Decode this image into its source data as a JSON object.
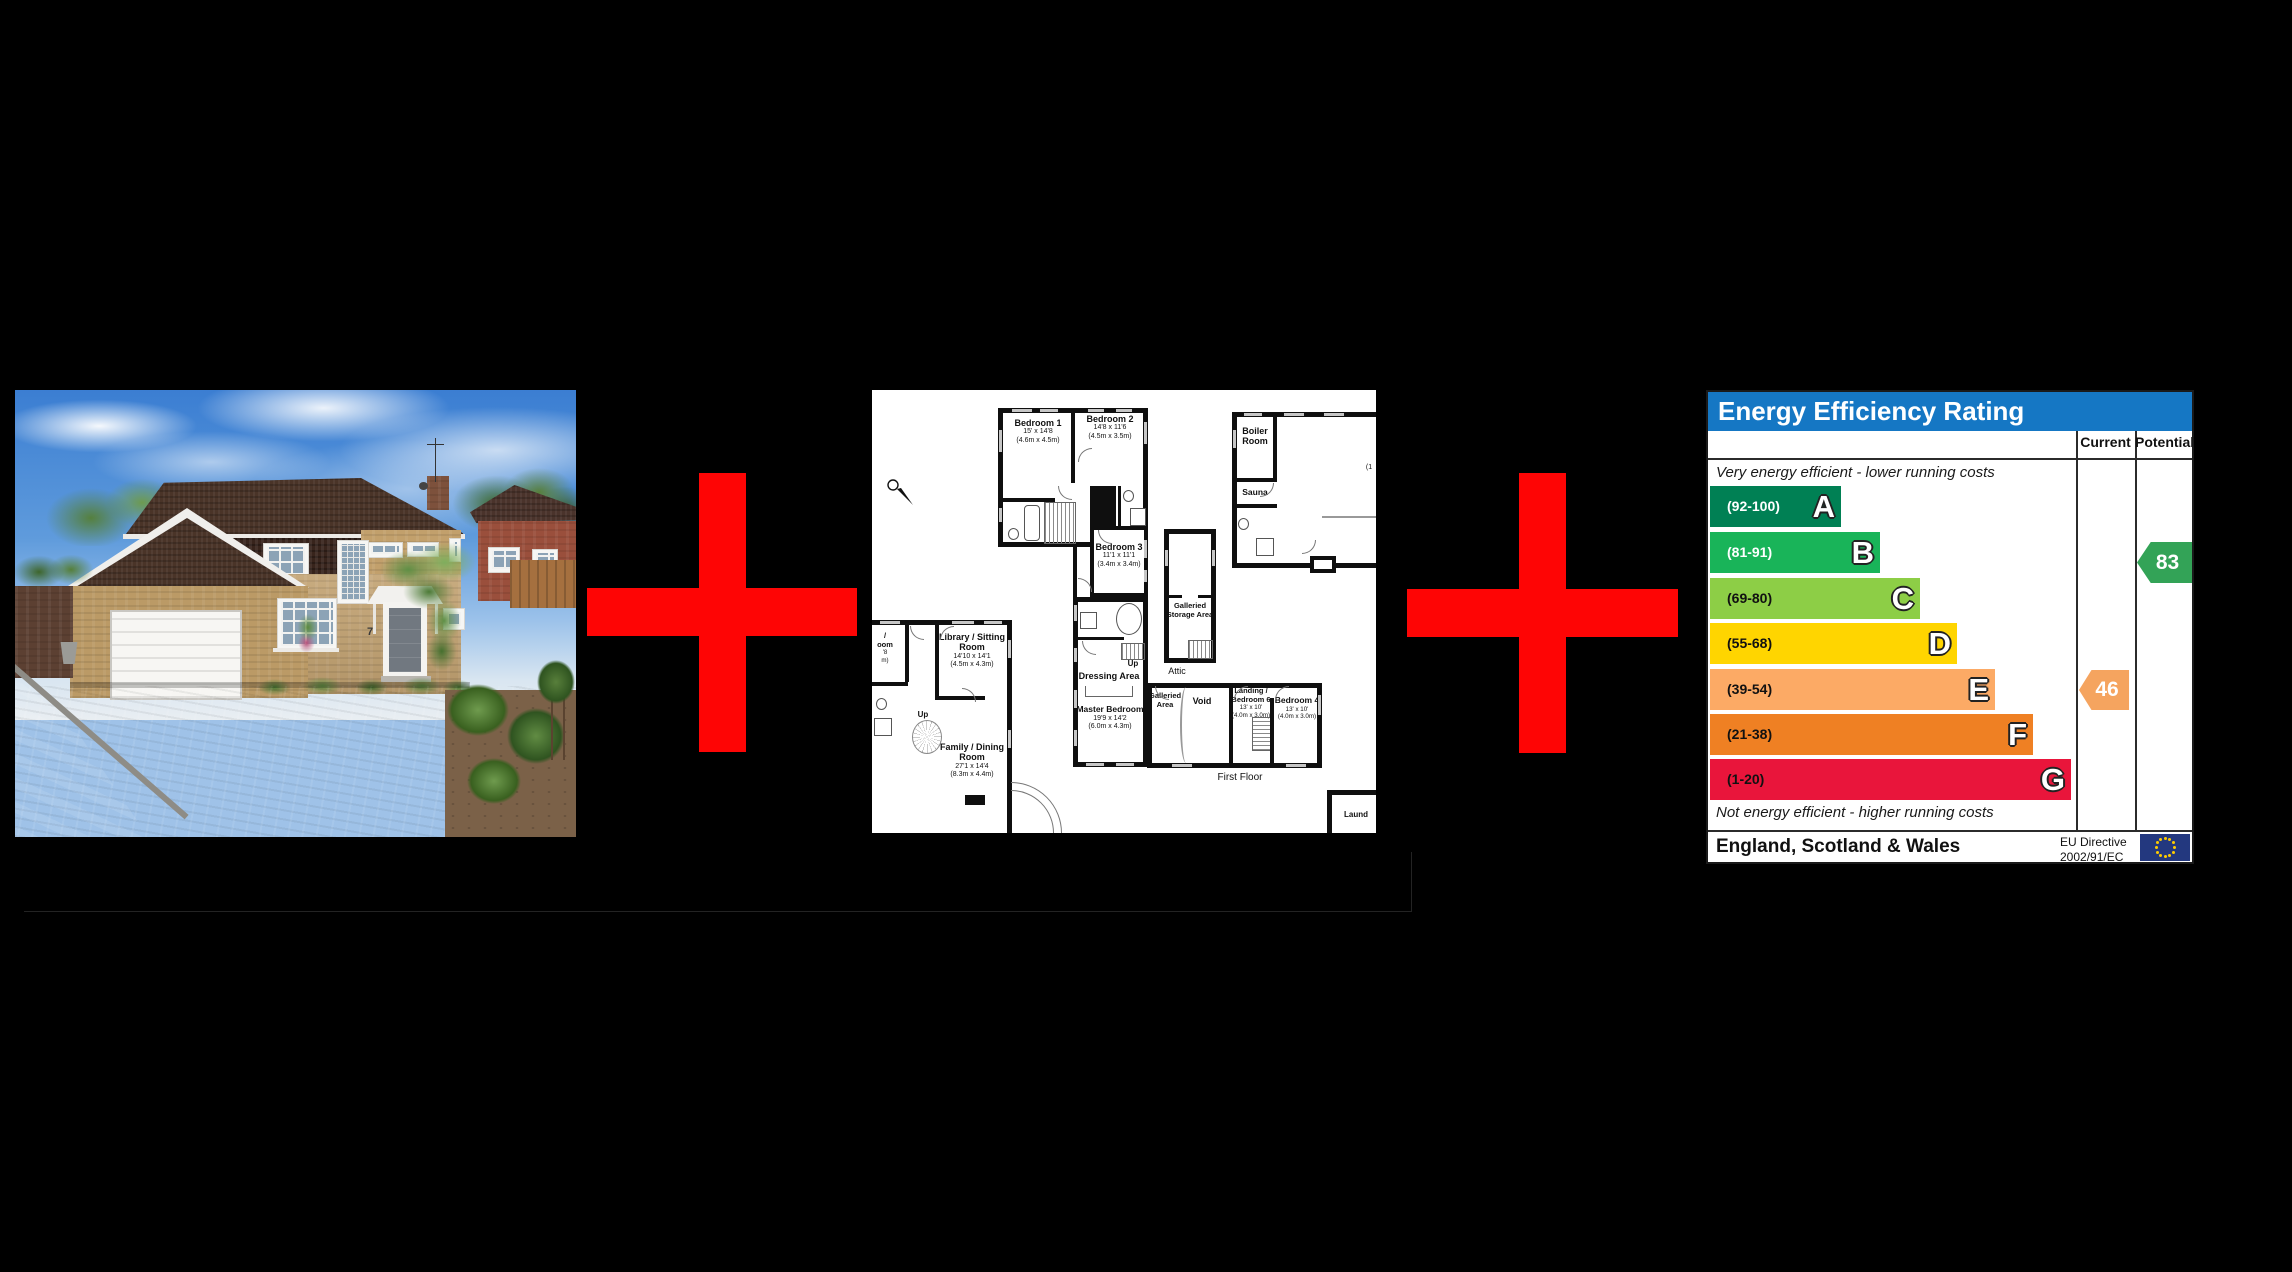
{
  "scene": {
    "background": "#000000",
    "plus_color": "#fe0505",
    "description": "Property listing composite: house photo + first-floor plan + EPC graph"
  },
  "house_photo": {
    "alt": "Detached brick house with double garage, block-paved driveway, lawn and shrubs under blue sky",
    "house_number": "7"
  },
  "floorplan": {
    "floor_label": "First Floor",
    "attic_label": "Attic",
    "up_label": "Up",
    "compass_letter": "N",
    "rooms": [
      {
        "name": "Bedroom 1",
        "dim_ft": "15' x 14'8",
        "dim_m": "(4.6m x 4.5m)"
      },
      {
        "name": "Bedroom 2",
        "dim_ft": "14'8 x 11'6",
        "dim_m": "(4.5m x 3.5m)"
      },
      {
        "name": "Bedroom 3",
        "dim_ft": "11'1 x 11'1",
        "dim_m": "(3.4m x 3.4m)"
      },
      {
        "name": "Master Bedroom",
        "dim_ft": "19'9 x 14'2",
        "dim_m": "(6.0m x 4.3m)"
      },
      {
        "name": "Dressing Area"
      },
      {
        "name": "Bedroom 4",
        "dim_ft": "13' x 10'",
        "dim_m": "(4.0m x 3.0m)"
      },
      {
        "name": "Landing / Bedroom 6",
        "dim_ft": "13' x 10'",
        "dim_m": "(4.0m x 3.0m)"
      },
      {
        "name": "Library / Sitting Room",
        "dim_ft": "14'10 x 14'1",
        "dim_m": "(4.5m x 4.3m)"
      },
      {
        "name": "Family / Dining Room",
        "dim_ft": "27'1 x 14'4",
        "dim_m": "(8.3m x 4.4m)"
      },
      {
        "name": "Boiler Room"
      },
      {
        "name": "Sauna"
      },
      {
        "name": "Galleried Storage Area"
      },
      {
        "name": "Galleried Area"
      },
      {
        "name": "Void"
      }
    ],
    "fragments": {
      "left_room": [
        "/",
        "oom",
        "'8",
        "m)"
      ],
      "laundry": "Laund",
      "right_room": "(1"
    }
  },
  "epc": {
    "title": "Energy Efficiency Rating",
    "columns": [
      "Current",
      "Potential"
    ],
    "top_note": "Very energy efficient - lower running costs",
    "bottom_note": "Not energy efficient - higher running costs",
    "header_bg": "#1577c4",
    "bands": [
      {
        "range": "(92-100)",
        "letter": "A",
        "color": "#008054"
      },
      {
        "range": "(81-91)",
        "letter": "B",
        "color": "#19b459"
      },
      {
        "range": "(69-80)",
        "letter": "C",
        "color": "#8dce46"
      },
      {
        "range": "(55-68)",
        "letter": "D",
        "color": "#ffd500"
      },
      {
        "range": "(39-54)",
        "letter": "E",
        "color": "#fcaa65"
      },
      {
        "range": "(21-38)",
        "letter": "F",
        "color": "#ef8023"
      },
      {
        "range": "(1-20)",
        "letter": "G",
        "color": "#e9153b"
      }
    ],
    "current": {
      "value": "46",
      "band": "E",
      "color": "#f5a45f"
    },
    "potential": {
      "value": "83",
      "band": "B",
      "color": "#33a357"
    },
    "footer_region": "England, Scotland & Wales",
    "directive_line1": "EU Directive",
    "directive_line2": "2002/91/EC",
    "flag": {
      "bg": "#23387f",
      "stars": "#ffcc00"
    }
  },
  "chart_data": {
    "type": "bar",
    "title": "Energy Efficiency Rating",
    "categories": [
      "A (92-100)",
      "B (81-91)",
      "C (69-80)",
      "D (55-68)",
      "E (39-54)",
      "F (21-38)",
      "G (1-20)"
    ],
    "values": [
      27,
      35,
      43,
      51,
      59,
      66,
      74
    ],
    "values_note": "fixed EPC scale bar lengths, % of panel width",
    "current_rating": 46,
    "current_band": "E",
    "potential_rating": 83,
    "potential_band": "B",
    "xlabel": "",
    "ylabel": "",
    "legend_position": "right columns: Current / Potential"
  }
}
